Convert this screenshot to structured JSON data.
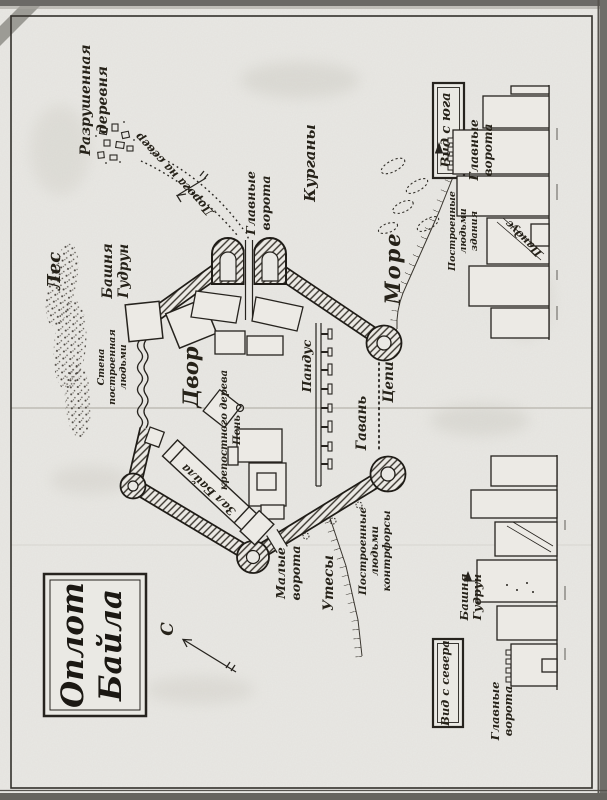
{
  "title_box": {
    "line1": "Оплот",
    "line2": "Байла"
  },
  "compass": {
    "north": "С"
  },
  "plan": {
    "village": {
      "l1": "Разрушенная",
      "l2": "деревня"
    },
    "road": {
      "label": "Дорога на север"
    },
    "main_gate": {
      "l1": "Главные",
      "l2": "ворота"
    },
    "mounds": {
      "label": "Курганы"
    },
    "sea": {
      "label": "Море"
    },
    "forest": {
      "label": "Лес"
    },
    "gudrun_tower": {
      "l1": "Башня",
      "l2": "Гудрун"
    },
    "man_wall": {
      "l1": "Стена",
      "l2": "построенная",
      "l3": "людьми"
    },
    "courtyard": {
      "label": "Двор"
    },
    "ramp": {
      "label": "Пандус"
    },
    "stump": {
      "l1": "Пень",
      "l2": "крепостного дерева"
    },
    "hall": {
      "label": "Зал Байла"
    },
    "small_gate": {
      "l1": "Малые",
      "l2": "ворота"
    },
    "cliffs": {
      "label": "Утесы"
    },
    "buttresses": {
      "l1": "Построенные",
      "l2": "людьми",
      "l3": "контрфорсы"
    },
    "harbor": {
      "label": "Гавань"
    },
    "chains": {
      "label": "Цепи"
    }
  },
  "south_view": {
    "box": "Вид с юга",
    "gate_l1": "Главные",
    "gate_l2": "ворота",
    "buildings_l1": "Построенные",
    "buildings_l2": "людьми",
    "buildings_l3": "здания",
    "ramp": "Пандус"
  },
  "north_view": {
    "box": "Вид с севера",
    "tower_l1": "Башня",
    "tower_l2": "Гудрун",
    "gate_l1": "Главные",
    "gate_l2": "ворота"
  },
  "colors": {
    "paper": "#e9e8e4",
    "ink": "#26231e"
  }
}
